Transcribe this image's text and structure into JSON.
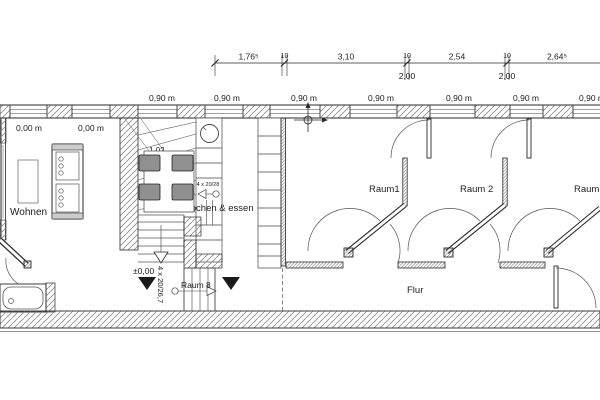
{
  "dim_chain": {
    "segments": [
      "1,76⁵",
      "10",
      "3,10",
      "10",
      "2,54",
      "10",
      "2,64⁵"
    ],
    "sub": [
      "2,00",
      "2,00"
    ]
  },
  "sills": {
    "low": "0,00 m",
    "high": "0,90 m"
  },
  "rooms": {
    "wohnen": "Wohnen",
    "kochen": "kochen & essen",
    "raum1": "Raum1",
    "raum2": "Raum 2",
    "raum3": "Raum 3",
    "raum8": "Raum 8",
    "flur": "Flur"
  },
  "stairs": {
    "main_width": "1,02",
    "main_spec": "17 x 18,5/23,4",
    "kitchen_spec": "4 x 20/28",
    "raum8_spec": "4 x 20/26,7"
  },
  "levels": {
    "zero": "±0,00"
  },
  "colors": {
    "line": "#2a2a2a",
    "hatch": "#8a8a8a",
    "chair_fill": "#909090",
    "paper": "#ffffff"
  }
}
